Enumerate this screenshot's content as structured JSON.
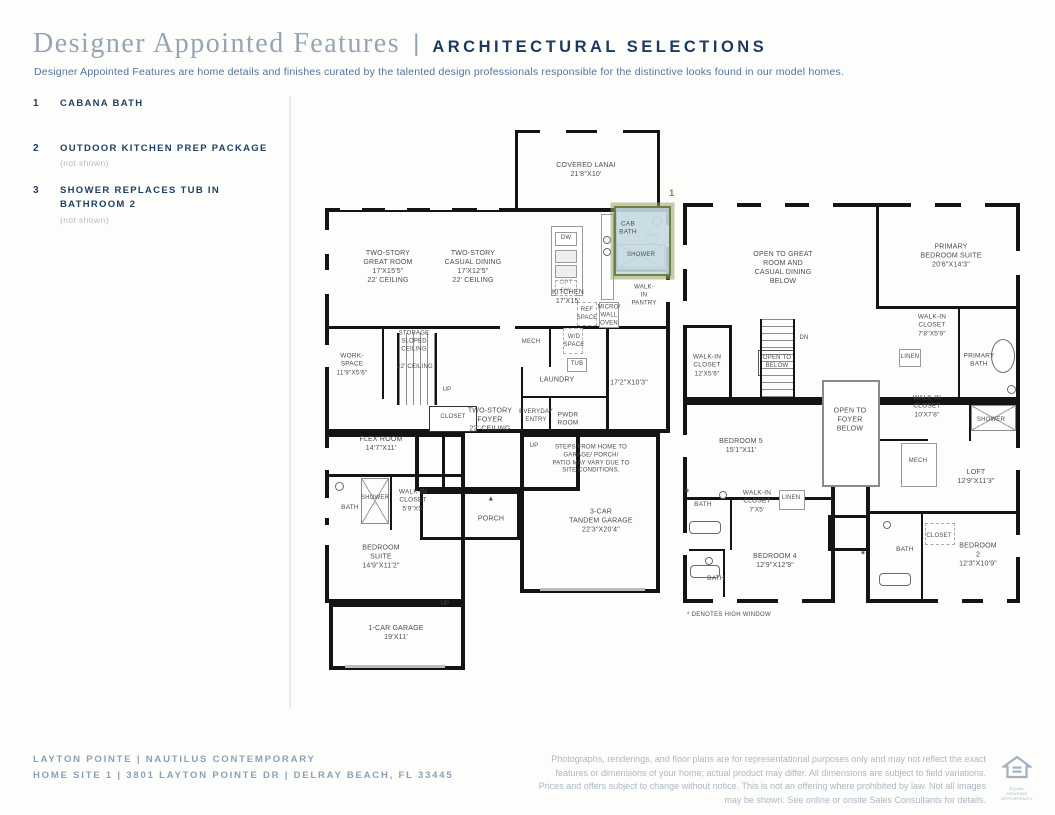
{
  "header": {
    "title": "Designer Appointed Features",
    "separator": "|",
    "title2": "ARCHITECTURAL SELECTIONS",
    "description": "Designer Appointed Features are home details and finishes curated by the talented design professionals responsible for the distinctive looks found in our model homes."
  },
  "features": [
    {
      "num": "1",
      "label": "CABANA BATH",
      "note": ""
    },
    {
      "num": "2",
      "label": "OUTDOOR KITCHEN PREP PACKAGE",
      "note": "(not shown)"
    },
    {
      "num": "3",
      "label": "SHOWER REPLACES TUB IN\nBATHROOM 2",
      "note": "(not shown)"
    }
  ],
  "colors": {
    "accent_navy": "#1d3c60",
    "slate_blue": "#51739b",
    "highlight_olive": "#6e813f",
    "cabana_bath_fill": "#c4d9e1",
    "muted_note_gray": "#b6bdc4",
    "footer_slate": "#8aa1b5",
    "wall_black": "#141414"
  },
  "plan1": {
    "marker": "1",
    "labels": [
      {
        "id": "label-covered-lanai",
        "t": "COVERED LANAI\n21'8\"X10'",
        "x": 261,
        "y": 40
      },
      {
        "id": "label-great-room",
        "t": "TWO-STORY\nGREAT ROOM\n17'X15'5\"\n22' CEILING",
        "x": 63,
        "y": 137
      },
      {
        "id": "label-casual-dining",
        "t": "TWO-STORY\nCASUAL DINING\n17'X12'5\"\n22' CEILING",
        "x": 148,
        "y": 137
      },
      {
        "id": "label-cab-bath",
        "t": "CAB\nBATH",
        "x": 303,
        "y": 99,
        "s": 6.5
      },
      {
        "id": "label-cab-shower",
        "t": "SHOWER",
        "x": 316,
        "y": 126,
        "s": 6
      },
      {
        "id": "label-dw",
        "t": "DW",
        "x": 241,
        "y": 109,
        "s": 6
      },
      {
        "id": "label-opt-dw",
        "t": "OPT\nDW",
        "x": 241,
        "y": 158,
        "s": 6,
        "c": "#9a9a9a"
      },
      {
        "id": "label-kitchen",
        "t": "KITCHEN\n17'X15'",
        "x": 243,
        "y": 167
      },
      {
        "id": "label-walk-in-pantry",
        "t": "WALK-IN\nPANTRY",
        "x": 319,
        "y": 166,
        "s": 6
      },
      {
        "id": "label-micro-wall-oven",
        "t": "MICRO/\nWALL\nOVEN",
        "x": 284,
        "y": 186,
        "s": 6
      },
      {
        "id": "label-ref-space",
        "t": "REF\nSPACE",
        "x": 262,
        "y": 185,
        "s": 6
      },
      {
        "id": "label-storage-sloped-ceiling",
        "t": "STORAGE\nSLOPED\nCEILING",
        "x": 89,
        "y": 212,
        "s": 6
      },
      {
        "id": "label-work-space",
        "t": "WORK-\nSPACE\n11'9\"X5'6\"",
        "x": 27,
        "y": 235,
        "s": 6.5
      },
      {
        "id": "label-22-ceiling",
        "t": "22' CEILING",
        "x": 90,
        "y": 238,
        "s": 6
      },
      {
        "id": "label-up-1",
        "t": "UP",
        "x": 122,
        "y": 261,
        "s": 6
      },
      {
        "id": "label-mech-1",
        "t": "MECH",
        "x": 206,
        "y": 213,
        "s": 6
      },
      {
        "id": "label-wd-space",
        "t": "W/D\nSPACE",
        "x": 249,
        "y": 212,
        "s": 6
      },
      {
        "id": "label-tub",
        "t": "TUB",
        "x": 252,
        "y": 235,
        "s": 6
      },
      {
        "id": "label-laundry",
        "t": "LAUNDRY",
        "x": 232,
        "y": 250
      },
      {
        "id": "label-dim-17-2",
        "t": "17'2\"X10'3\"",
        "x": 304,
        "y": 253
      },
      {
        "id": "label-closet-1",
        "t": "CLOSET",
        "x": 128,
        "y": 288,
        "s": 6
      },
      {
        "id": "label-two-story-foyer",
        "t": "TWO-STORY\nFOYER\n22' CEILING",
        "x": 165,
        "y": 290
      },
      {
        "id": "label-everyday-entry",
        "t": "EVERYDAY\nENTRY",
        "x": 211,
        "y": 287,
        "s": 6
      },
      {
        "id": "label-pwdr-room",
        "t": "PWDR\nROOM",
        "x": 243,
        "y": 290,
        "s": 6.5
      },
      {
        "id": "label-flex-room",
        "t": "FLEX ROOM\n14'7\"X11'",
        "x": 56,
        "y": 314
      },
      {
        "id": "label-up-2",
        "t": "UP",
        "x": 209,
        "y": 317,
        "s": 6
      },
      {
        "id": "label-steps-note",
        "t": "STEPS FROM HOME TO GARAGE/ PORCH/\nPATIO MAY VARY DUE TO SITE CONDITIONS.",
        "x": 266,
        "y": 330,
        "s": 6
      },
      {
        "id": "label-bath-1",
        "t": "BATH",
        "x": 25,
        "y": 378,
        "s": 6.5
      },
      {
        "id": "label-shower-1",
        "t": "SHOWER",
        "x": 50,
        "y": 369,
        "s": 6
      },
      {
        "id": "label-wic-59",
        "t": "WALK-IN\nCLOSET\n5'9\"X5'",
        "x": 88,
        "y": 371,
        "s": 6.5
      },
      {
        "id": "label-bedroom-suite",
        "t": "BEDROOM\nSUITE\n14'9\"X11'2\"",
        "x": 56,
        "y": 427
      },
      {
        "id": "label-front-door",
        "t": "▲",
        "x": 166,
        "y": 369,
        "s": 7
      },
      {
        "id": "label-porch",
        "t": "PORCH",
        "x": 166,
        "y": 389
      },
      {
        "id": "label-3car-garage",
        "t": "3-CAR\nTANDEM GARAGE\n22'3\"X20'4\"",
        "x": 276,
        "y": 391
      },
      {
        "id": "label-up-3",
        "t": "UP",
        "x": 120,
        "y": 475,
        "s": 6
      },
      {
        "id": "label-1car-garage",
        "t": "1-CAR GARAGE\n19'X11'",
        "x": 71,
        "y": 503
      }
    ]
  },
  "plan2": {
    "note": "* DENOTES HIGH WINDOW",
    "labels": [
      {
        "id": "label-open-to-great",
        "t": "OPEN TO GREAT\nROOM AND\nCASUAL DINING\nBELOW",
        "x": 100,
        "y": 65
      },
      {
        "id": "label-primary-suite",
        "t": "PRIMARY\nBEDROOM SUITE\n20'6\"X14'3\"",
        "x": 268,
        "y": 53
      },
      {
        "id": "label-wic-78",
        "t": "WALK-IN\nCLOSET\n7'8\"X5'9\"",
        "x": 249,
        "y": 123,
        "s": 6.5
      },
      {
        "id": "label-linen-1",
        "t": "LINEN",
        "x": 227,
        "y": 155,
        "s": 6
      },
      {
        "id": "label-primary-bath",
        "t": "PRIMARY\nBATH",
        "x": 296,
        "y": 158,
        "s": 6.5
      },
      {
        "id": "label-wic-12",
        "t": "WALK-IN\nCLOSET\n12'X5'6\"",
        "x": 24,
        "y": 163,
        "s": 6.5
      },
      {
        "id": "label-open-to-below",
        "t": "OPEN TO\nBELOW",
        "x": 94,
        "y": 160,
        "s": 6
      },
      {
        "id": "label-dn",
        "t": "← DN",
        "x": 117,
        "y": 136,
        "s": 6
      },
      {
        "id": "label-wic-10",
        "t": "WALK-IN\nCLOSET\n10'X7'8\"",
        "x": 244,
        "y": 204,
        "s": 6.5
      },
      {
        "id": "label-shower-2",
        "t": "SHOWER",
        "x": 308,
        "y": 218,
        "s": 6
      },
      {
        "id": "label-mech-2",
        "t": "MECH",
        "x": 235,
        "y": 259,
        "s": 6
      },
      {
        "id": "label-loft",
        "t": "LOFT\n12'9\"X11'3\"",
        "x": 293,
        "y": 274
      },
      {
        "id": "label-bedroom-5",
        "t": "BEDROOM 5\n15'1\"X11'",
        "x": 58,
        "y": 243
      },
      {
        "id": "label-open-to-foyer",
        "t": "OPEN TO\nFOYER\nBELOW",
        "x": 167,
        "y": 217
      },
      {
        "id": "label-bath-2a",
        "t": "BATH",
        "x": 20,
        "y": 302,
        "s": 6.5
      },
      {
        "id": "label-wic-7x5",
        "t": "WALK-IN\nCLOSET\n7'X5'",
        "x": 74,
        "y": 299,
        "s": 6.5
      },
      {
        "id": "label-linen-2",
        "t": "LINEN",
        "x": 108,
        "y": 296,
        "s": 6
      },
      {
        "id": "label-bedroom-4",
        "t": "BEDROOM 4\n12'9\"X12'9\"",
        "x": 92,
        "y": 358
      },
      {
        "id": "label-bath-2b",
        "t": "BATH",
        "x": 33,
        "y": 376,
        "s": 6.5
      },
      {
        "id": "label-bath-2c",
        "t": "BATH",
        "x": 222,
        "y": 347,
        "s": 6.5
      },
      {
        "id": "label-closet-2",
        "t": "CLOSET",
        "x": 256,
        "y": 334,
        "s": 6
      },
      {
        "id": "label-bedroom-2",
        "t": "BEDROOM 2\n12'3\"X10'9\"",
        "x": 295,
        "y": 352
      },
      {
        "id": "label-star-1",
        "t": "*",
        "x": 4,
        "y": 290,
        "s": 10,
        "b": true
      },
      {
        "id": "label-star-2",
        "t": "*",
        "x": 180,
        "y": 352,
        "s": 10,
        "b": true
      }
    ]
  },
  "footer": {
    "line1": "LAYTON POINTE | NAUTILUS CONTEMPORARY",
    "line2": "HOME SITE 1 | 3801 LAYTON POINTE DR | DELRAY BEACH, FL 33445",
    "disclaimer": "Photographs, renderings, and floor plans are for representational purposes only and may not reflect the exact features or dimensions of your home; actual product may differ. All dimensions are subject to field variations. Prices and offers subject to change without notice. This is not an offering where prohibited by law. Not all images may be shown. See online or onsite Sales Consultants for details.",
    "logo_caption": "EQUAL HOUSING OPPORTUNITY"
  }
}
